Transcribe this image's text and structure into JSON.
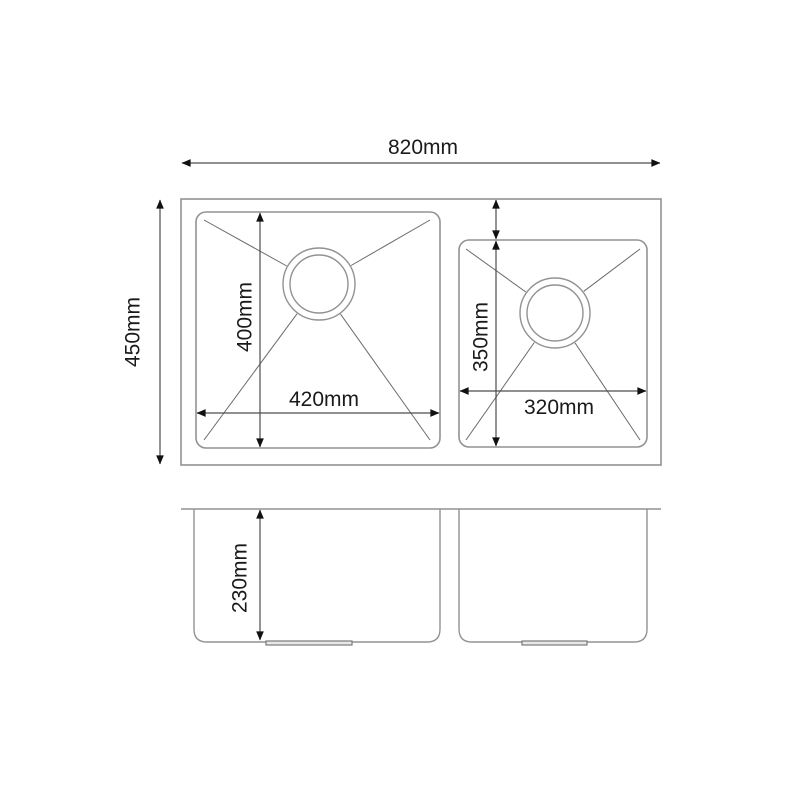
{
  "diagram": {
    "type": "double-bowl-sink-dimension-drawing",
    "top_view": {
      "overall_width_label": "820mm",
      "overall_depth_label": "450mm",
      "left_bowl": {
        "inner_width_label": "420mm",
        "inner_depth_label": "400mm"
      },
      "right_bowl": {
        "inner_width_label": "320mm",
        "inner_depth_label": "350mm"
      }
    },
    "front_view": {
      "bowl_height_label": "230mm"
    }
  },
  "colors": {
    "background": "#ffffff",
    "outline": "#929292",
    "dimension_line": "#4d4d4d",
    "arrow": "#111111",
    "text": "#1a1a1a"
  }
}
